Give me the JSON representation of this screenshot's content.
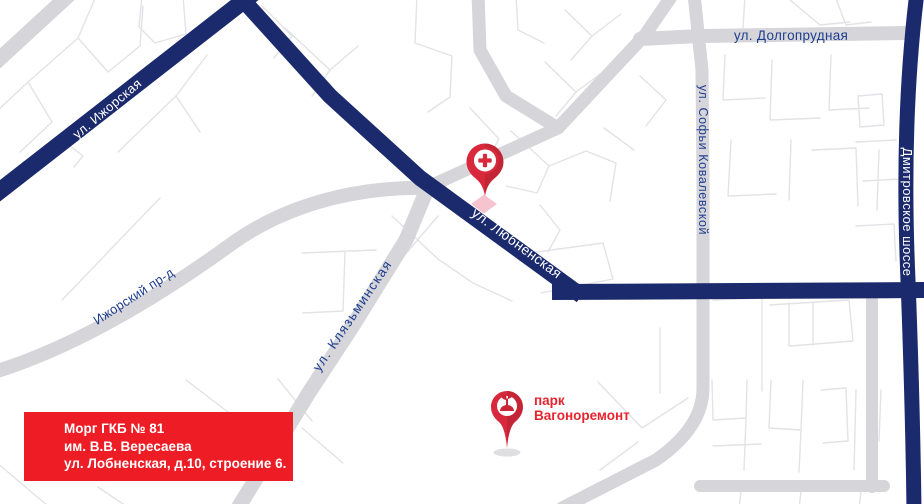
{
  "map": {
    "type": "static-city-map",
    "road_labels": {
      "dolgoprudnaya": "ул. Долгопрудная",
      "sofyi_kovalevskoy": "ул. Софьи Ковалевской",
      "dmitrovskoe_shosse": "Дмитровское шоссе",
      "izhorskaya": "ул. Ижорская",
      "lyubnenskaya": "ул. Любненская",
      "izhorskiy_proezd": "Ижорский пр-д",
      "klyazminskaya": "ул. Клязьминская"
    },
    "poi_labels": {
      "park_line1": "парк",
      "park_line2": "Вагоноремонт"
    },
    "markers": {
      "hospital": "medical-cross",
      "park": "park-sprout"
    },
    "colors": {
      "major_road": "#1b2a6c",
      "secondary_road": "#d6d6da",
      "minor_street": "#e3e3e7",
      "label_blue": "#1f3e8e",
      "label_white": "#ffffff",
      "poi_red": "#e5242e",
      "pin_red": "#d8293c",
      "pin_diamond_pink": "#f3bac6",
      "info_box_red": "#ee1c24"
    }
  },
  "info_box": {
    "line1": "Морг ГКБ № 81",
    "line2": "им. В.В. Вересаева",
    "line3": "ул. Лобненская, д.10, строение 6."
  }
}
